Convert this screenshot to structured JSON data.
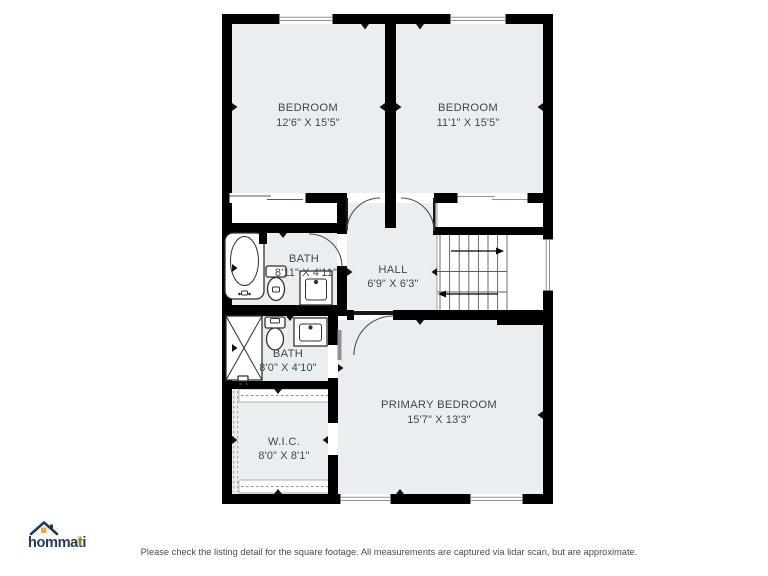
{
  "colors": {
    "wall": "#000000",
    "room_fill": "#eaeef1",
    "label_text": "#3f464b",
    "stair_line": "#5a6065",
    "logo_navy": "#1d3c5e",
    "logo_orange": "#f2a93c",
    "disclaimer_text": "#4b4b4b"
  },
  "plan": {
    "rooms": [
      {
        "name": "BEDROOM",
        "dims": "12'6\" X 15'5\""
      },
      {
        "name": "BEDROOM",
        "dims": "11'1\" X 15'5\""
      },
      {
        "name": "BATH",
        "dims": "8'11\" X 4'11\""
      },
      {
        "name": "HALL",
        "dims": "6'9\" X 6'3\""
      },
      {
        "name": "BATH",
        "dims": "8'0\" X 4'10\""
      },
      {
        "name": "W.I.C.",
        "dims": "8'0\" X 8'1\""
      },
      {
        "name": "PRIMARY BEDROOM",
        "dims": "15'7\" X 13'3\""
      }
    ]
  },
  "branding": {
    "logo_text": "hommati"
  },
  "footer": {
    "disclaimer": "Please check the listing detail for the square footage. All measurements are captured via lidar scan, but are approximate."
  }
}
